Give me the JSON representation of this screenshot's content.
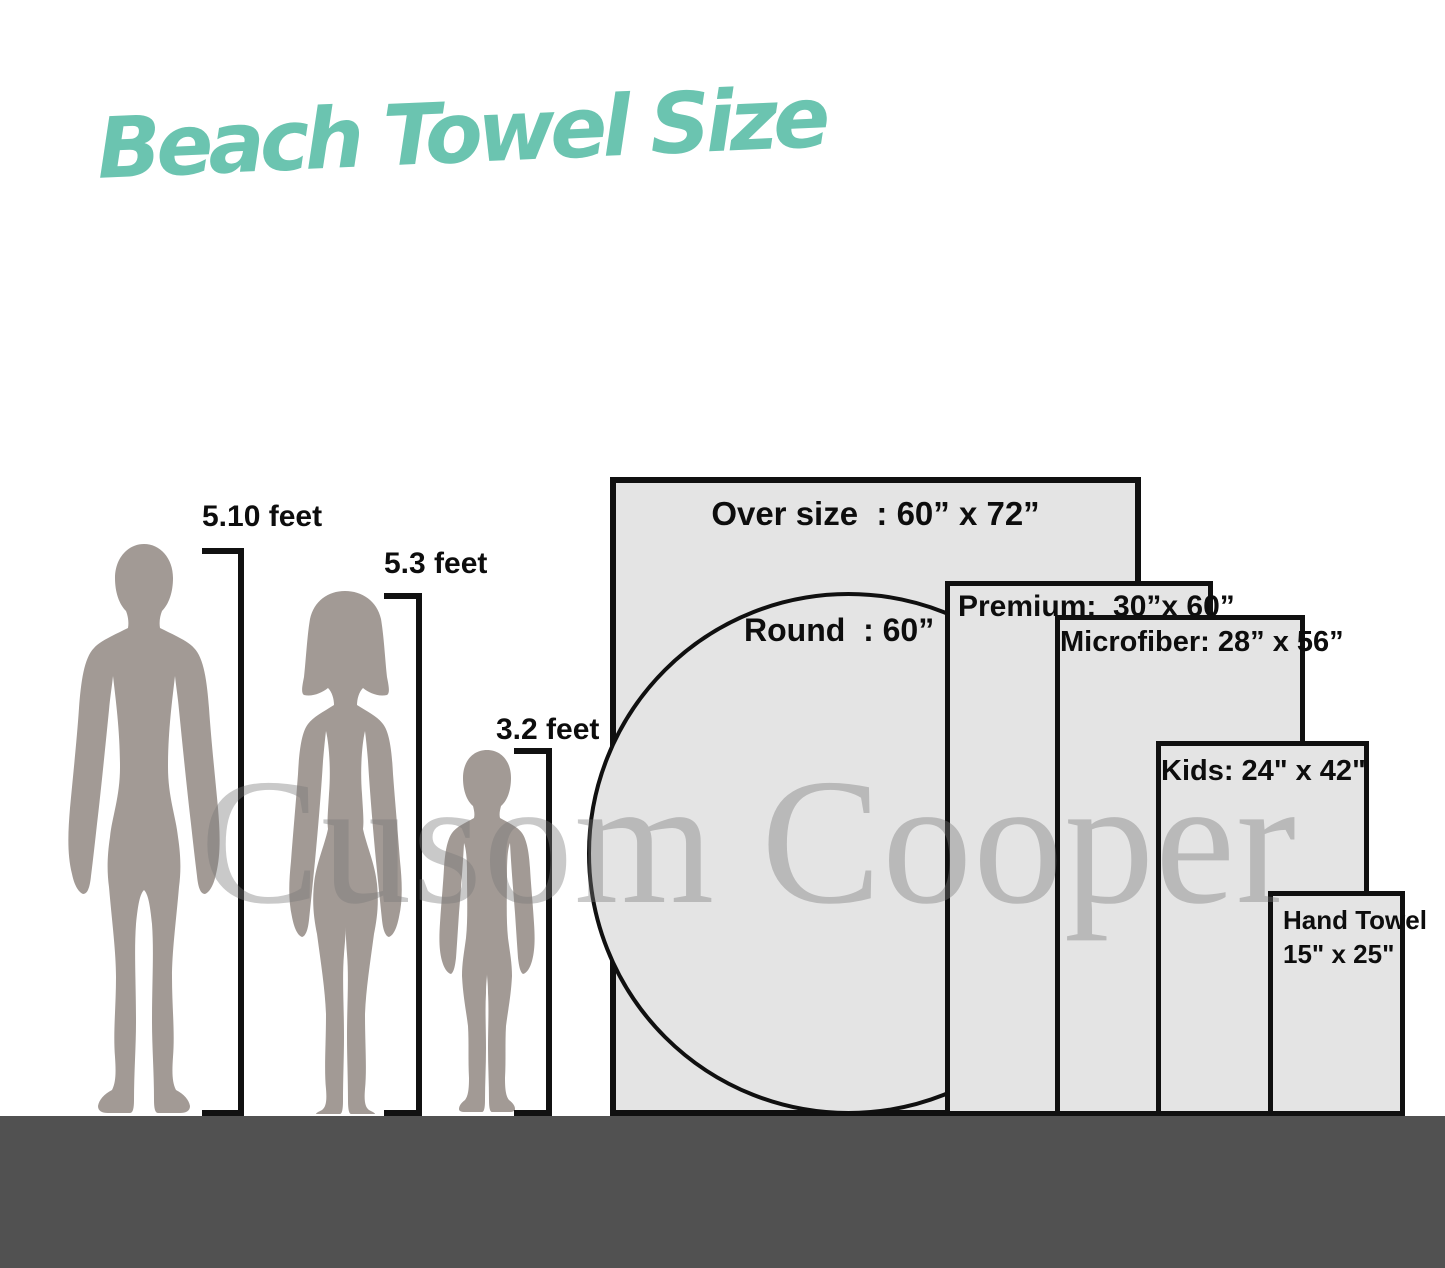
{
  "title": {
    "text": "Beach Towel Size",
    "color": "#6bc4b0"
  },
  "watermark": {
    "text": "Cusom Cooper"
  },
  "figures": {
    "man": {
      "height_label": "5.10 feet",
      "height_feet": 5.1
    },
    "woman": {
      "height_label": "5.3 feet",
      "height_feet": 5.3
    },
    "child": {
      "height_label": "3.2 feet",
      "height_feet": 3.2
    }
  },
  "towels": {
    "oversize": {
      "label": "Over size  : 60” x 72”",
      "width_in": 60,
      "height_in": 72
    },
    "round": {
      "label": "Round  : 60”",
      "diameter_in": 60
    },
    "premium": {
      "label": "Premium:  30”x 60”",
      "width_in": 30,
      "height_in": 60
    },
    "microfiber": {
      "label": "Microfiber: 28” x 56”",
      "width_in": 28,
      "height_in": 56
    },
    "kids": {
      "label": "Kids: 24\" x 42\"",
      "width_in": 24,
      "height_in": 42
    },
    "hand": {
      "label_line1": "Hand Towel",
      "label_line2": "15\" x 25\"",
      "width_in": 15,
      "height_in": 25
    }
  },
  "colors": {
    "accent_teal": "#6bc4b0",
    "towel_fill": "#e4e4e4",
    "outline": "#101010",
    "floor": "#515151",
    "silhouette": "#a29a95",
    "watermark_gray": "#c9c9c9"
  }
}
